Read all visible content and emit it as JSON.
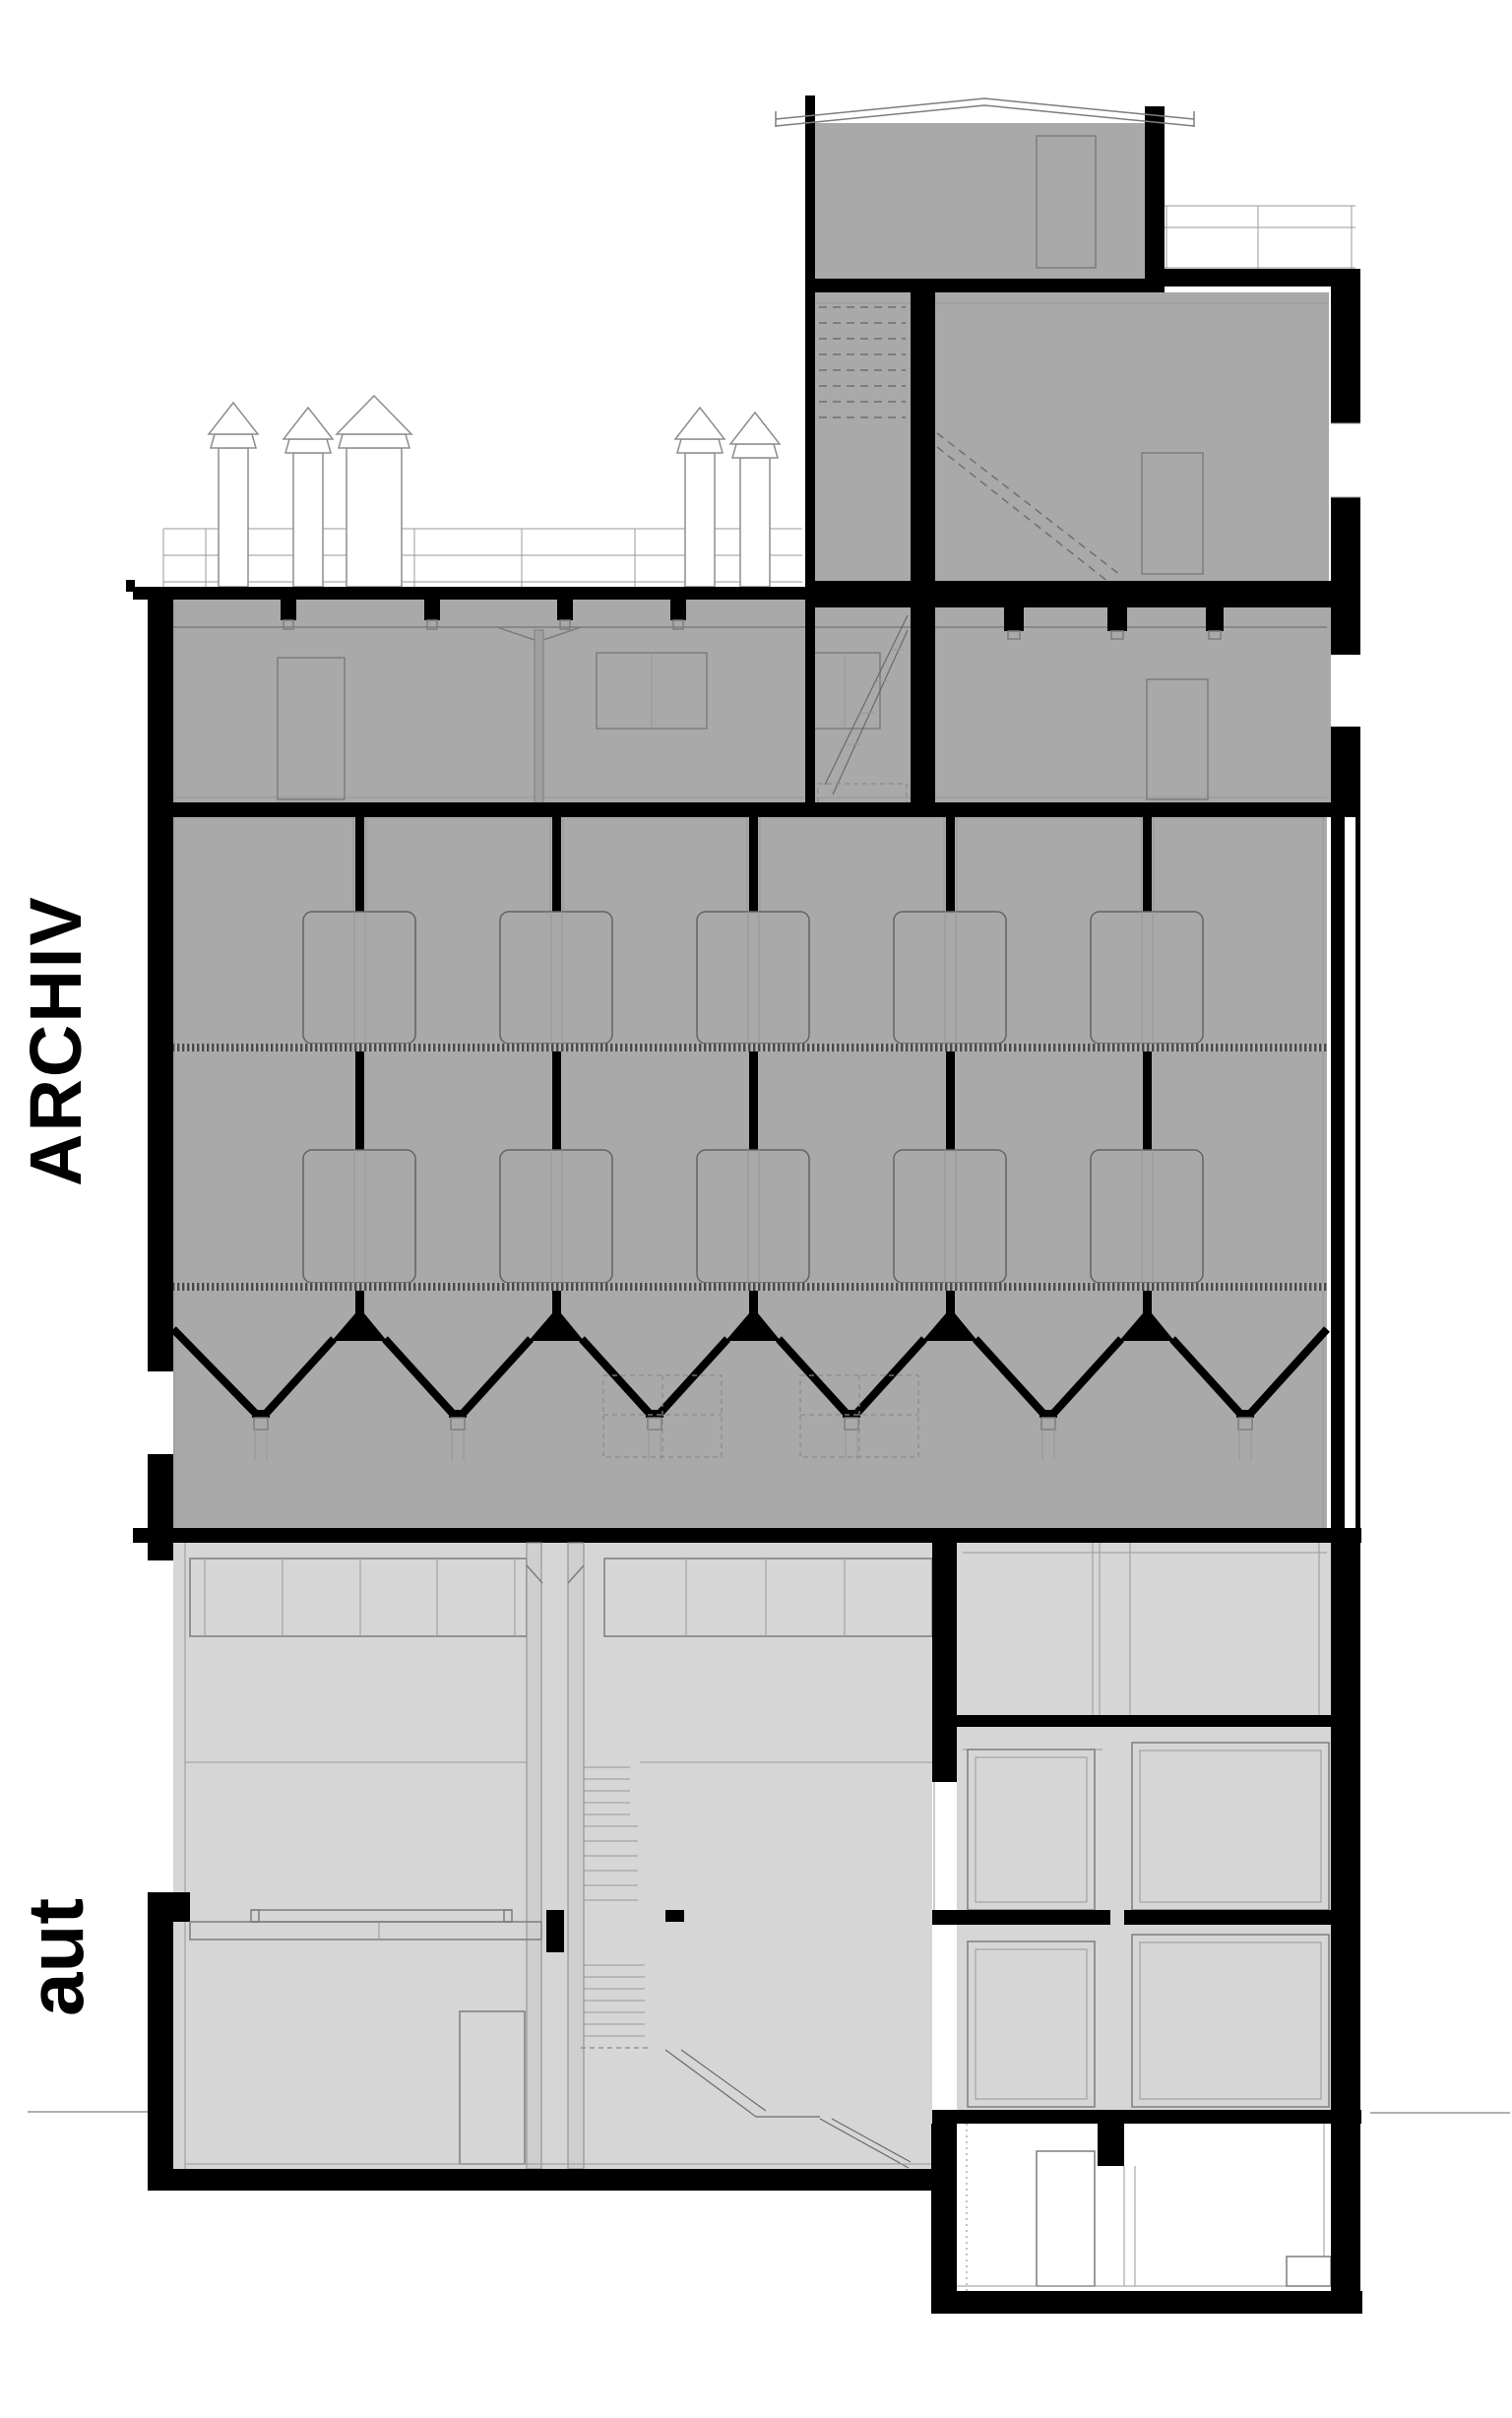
{
  "labels": {
    "archiv": "ARCHIV",
    "aut": "aut"
  },
  "colors": {
    "background": "#ffffff",
    "room_dark": "#a9a9a9",
    "room_light": "#d6d6d6",
    "structure_black": "#000000",
    "outline_gray": "#7d7d7d",
    "grate_dark": "#4a4a4a",
    "grate_light": "#b2b2b2"
  }
}
